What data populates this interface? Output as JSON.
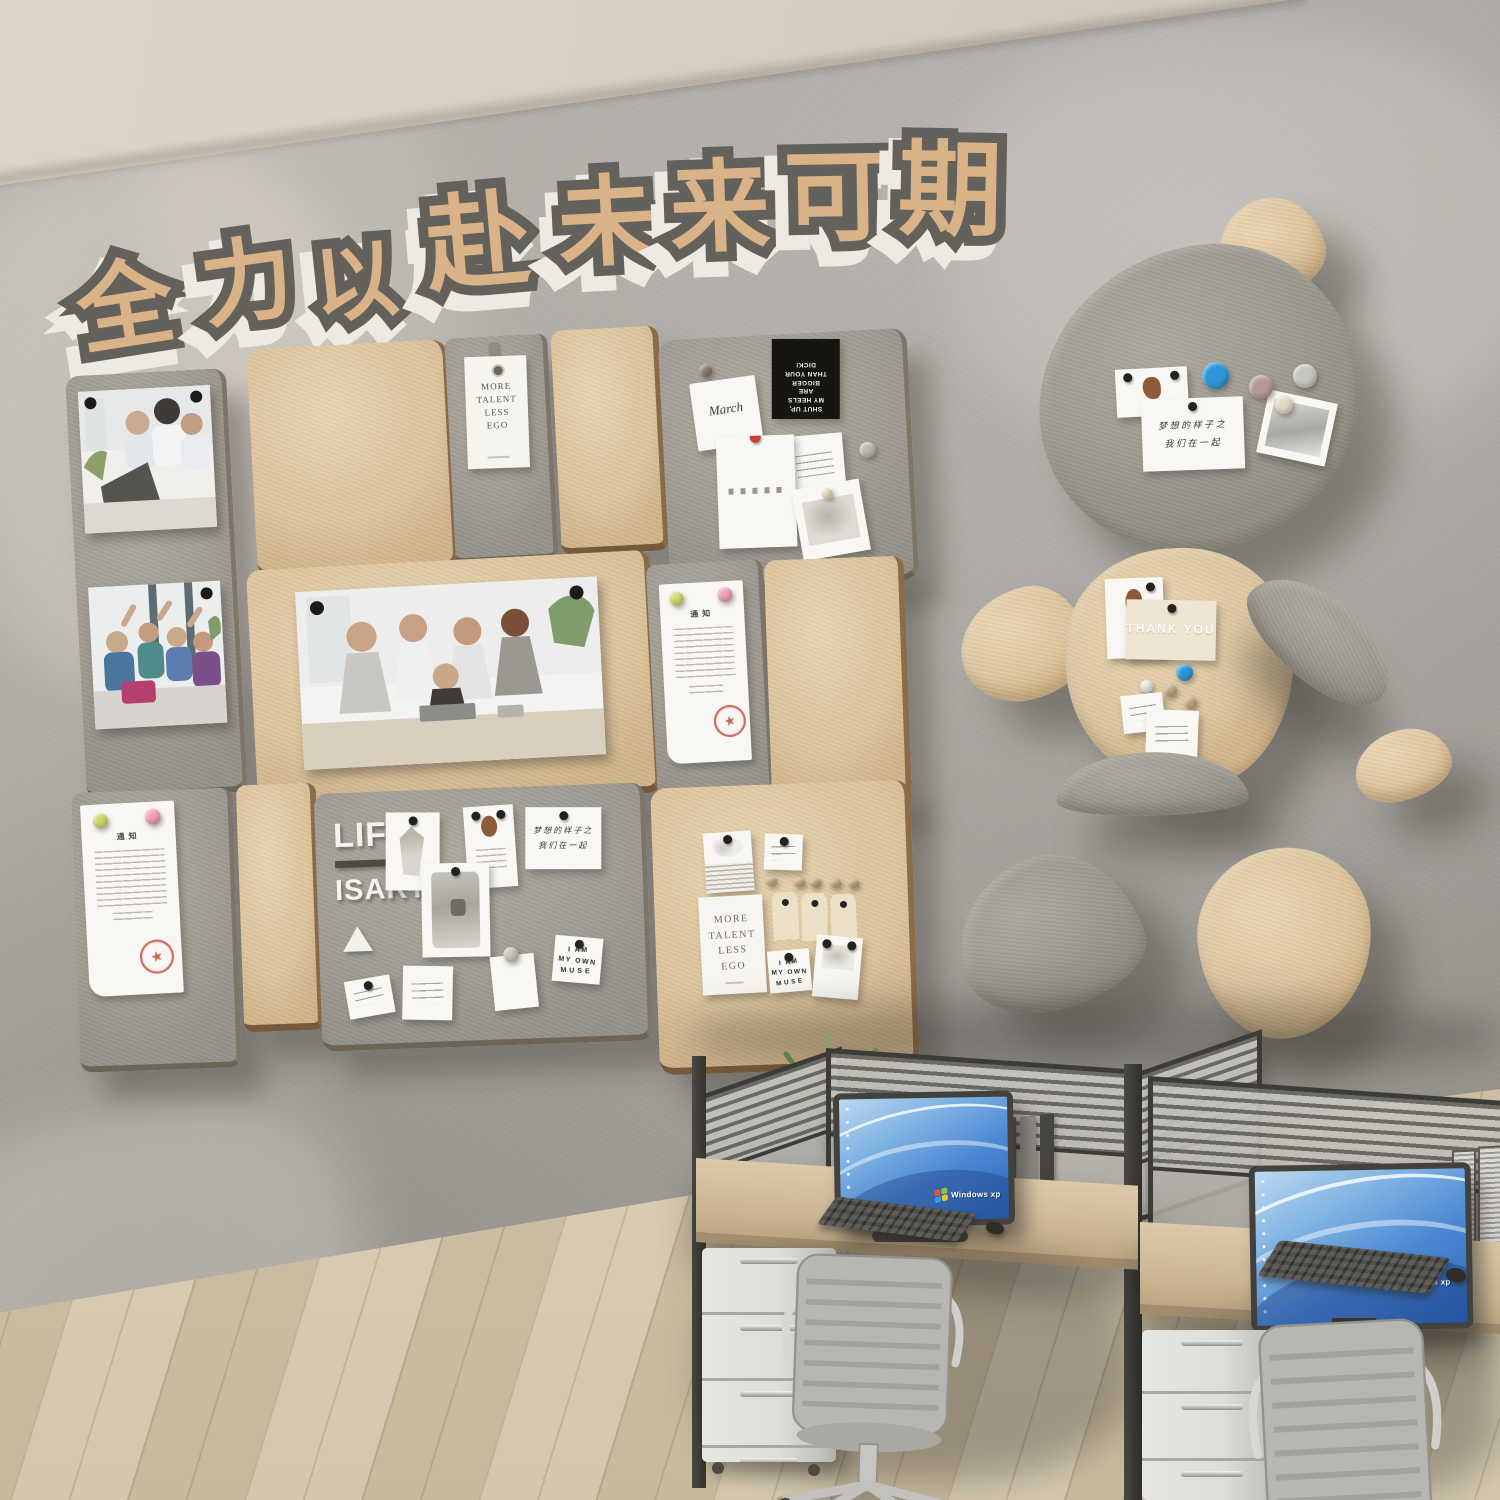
{
  "slogan": {
    "characters": [
      "全",
      "力",
      "以",
      "赴",
      "未",
      "来",
      "可",
      "期"
    ],
    "fill_color": "#d9b387",
    "outline_color": "#63615b",
    "extrude_color": "#edeae4"
  },
  "texts": {
    "more_talent": [
      "MORE",
      "TALENT",
      "LESS",
      "EGO"
    ],
    "march": "March",
    "black_card": [
      "SHUT UP,",
      "MY HEELS",
      "ARE",
      "BIGGER",
      "THAN YOUR",
      "DICK!"
    ],
    "notice_title": "通知",
    "life": "LIFE",
    "is_art": "ISART",
    "chinese_note": [
      "梦想的样子之",
      "我们在一起"
    ],
    "muse": [
      "I AM",
      "MY OWN",
      "MUSE"
    ],
    "thank_you": "THANK YOU",
    "windows_logo": "Windows xp"
  },
  "colors": {
    "wall": "#a7a49e",
    "ceiling": "#d7cfc1",
    "felt_gray": "#a09c92",
    "felt_tan": "#ddc59d",
    "stamp_red": "#c23b2e",
    "magnet_blue": "#2e96d6",
    "magnet_green": "#cddc6a",
    "magnet_pink": "#f0a0b4",
    "desk_wood": "#c9b493",
    "floor_wood": "#d8ccb2",
    "chair_gray": "#b7b6b2",
    "screen_blue": "#3d7ccb"
  }
}
